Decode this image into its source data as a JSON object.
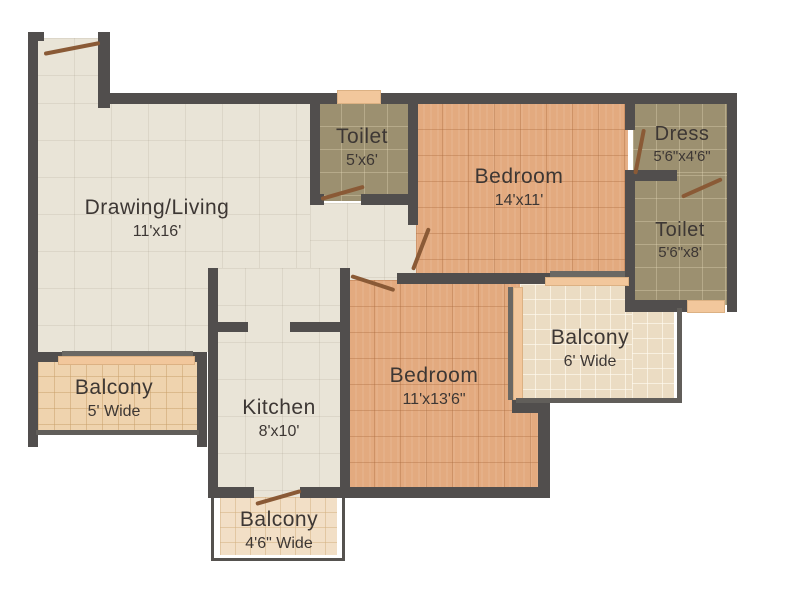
{
  "plan_title": "2 BHK Floor Plan",
  "rooms": {
    "drawing_living": {
      "name": "Drawing/Living",
      "dims": "11'x16'"
    },
    "toilet1": {
      "name": "Toilet",
      "dims": "5'x6'"
    },
    "bedroom1": {
      "name": "Bedroom",
      "dims": "14'x11'"
    },
    "dress": {
      "name": "Dress",
      "dims": "5'6\"x4'6\""
    },
    "toilet2": {
      "name": "Toilet",
      "dims": "5'6\"x8'"
    },
    "balcony_living": {
      "name": "Balcony",
      "dims": "5' Wide"
    },
    "kitchen": {
      "name": "Kitchen",
      "dims": "8'x10'"
    },
    "bedroom2": {
      "name": "Bedroom",
      "dims": "11'x13'6\""
    },
    "balcony_bed1": {
      "name": "Balcony",
      "dims": "6' Wide"
    },
    "balcony_kitchen": {
      "name": "Balcony",
      "dims": "4'6\" Wide"
    }
  },
  "palette": {
    "wall": "#514e4d",
    "floor_cream": "#e9e4d7",
    "floor_terracotta": "#e3aa7f",
    "floor_olive": "#9c9070",
    "floor_balcony": "#efd3ae",
    "window_sill": "#f2c79c",
    "door_swing": "#8a5a36",
    "text": "#3d3734",
    "background": "#ffffff"
  }
}
